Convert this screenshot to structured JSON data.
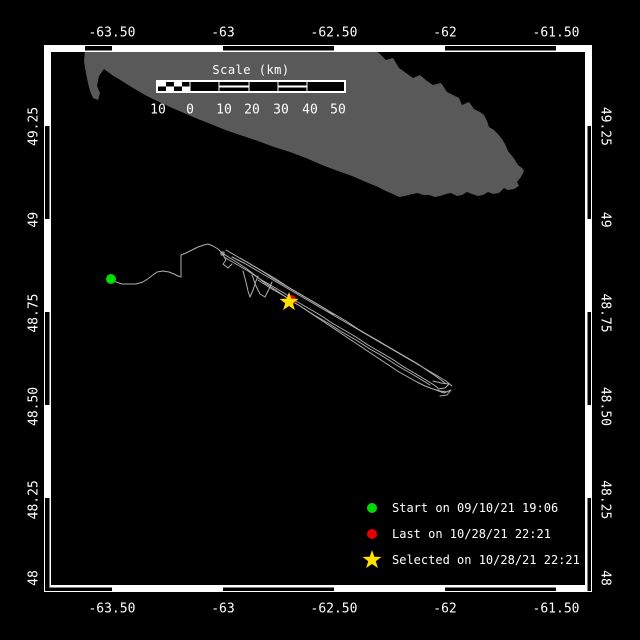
{
  "colors": {
    "background": "#000000",
    "frame": "#ffffff",
    "text": "#ffffff",
    "land": "#595959",
    "track": "#b0b0b0",
    "start": "#00dc00",
    "last": "#e80000",
    "selected": "#ffe000"
  },
  "scale_bar": {
    "title": "Scale (km)",
    "tick_labels": [
      "10",
      "0",
      "10",
      "20",
      "30",
      "40",
      "50"
    ],
    "geom": {
      "x": 157,
      "y": 81,
      "w": 188,
      "h": 11,
      "checker_start": 158,
      "checker_end": 190,
      "stripe_segs": [
        [
          219,
          249
        ],
        [
          278,
          307
        ]
      ],
      "separators": [
        190,
        219,
        249,
        278,
        307
      ],
      "label_xs": [
        158,
        190,
        224,
        252,
        281,
        310,
        338
      ],
      "labels_y": 110
    }
  },
  "legend": {
    "items": [
      {
        "marker": "start-dot",
        "label": "Start on 09/10/21 19:06"
      },
      {
        "marker": "last-dot",
        "label": "Last on 10/28/21 22:21"
      },
      {
        "marker": "selected-star",
        "label": "Selected on 10/28/21 22:21"
      }
    ]
  },
  "frame_pattern": {
    "top": [
      [
        85,
        112
      ],
      [
        223,
        334
      ],
      [
        445,
        556
      ]
    ],
    "bottom": [
      [
        44,
        112
      ],
      [
        223,
        334
      ],
      [
        445,
        556
      ]
    ],
    "left": [
      [
        126,
        219
      ],
      [
        312,
        405
      ],
      [
        498,
        591
      ]
    ],
    "right": [
      [
        126,
        219
      ],
      [
        312,
        405
      ],
      [
        498,
        591
      ]
    ]
  },
  "chart_data": {
    "type": "map-track",
    "description": "Telemetry track map with start, last and selected positions",
    "lon_axis": {
      "labels": [
        "-63.50",
        "-63",
        "-62.50",
        "-62",
        "-61.50"
      ],
      "values": [
        -63.5,
        -63,
        -62.5,
        -62,
        -61.5
      ]
    },
    "lat_axis": {
      "labels": [
        "49.25",
        "49",
        "48.75",
        "48.50",
        "48.25",
        "48"
      ],
      "values": [
        49.25,
        49,
        48.75,
        48.5,
        48.25,
        48
      ]
    },
    "projection": {
      "x0": 44,
      "x1": 592,
      "lon0": -63.806,
      "lon1": -61.338,
      "y0": 45,
      "y1": 592,
      "lat0": 49.468,
      "lat1": 48.003
    },
    "label_pos": {
      "top_y": 33,
      "bottom_y": 609,
      "left_x": 34,
      "right_x": 605,
      "lat_clamp_y": 578
    },
    "markers": {
      "start": {
        "lon": -63.5,
        "lat": 48.84,
        "px": [
          111,
          279
        ],
        "r": 5
      },
      "last": {
        "lon": -62.69,
        "lat": 48.78,
        "px": [
          291,
          300
        ],
        "r": 5
      },
      "selected": {
        "lon": -62.7,
        "lat": 48.78,
        "px": [
          289,
          302
        ],
        "R": 10,
        "r": 4
      }
    },
    "island_polygon": [
      [
        85,
        48
      ],
      [
        373,
        48
      ],
      [
        380,
        54
      ],
      [
        386,
        60
      ],
      [
        393,
        58
      ],
      [
        399,
        68
      ],
      [
        406,
        73
      ],
      [
        413,
        78
      ],
      [
        420,
        75
      ],
      [
        427,
        81
      ],
      [
        433,
        85
      ],
      [
        441,
        83
      ],
      [
        447,
        92
      ],
      [
        453,
        95
      ],
      [
        459,
        98
      ],
      [
        462,
        105
      ],
      [
        469,
        102
      ],
      [
        474,
        109
      ],
      [
        480,
        112
      ],
      [
        484,
        115
      ],
      [
        487,
        121
      ],
      [
        489,
        127
      ],
      [
        494,
        130
      ],
      [
        498,
        134
      ],
      [
        502,
        139
      ],
      [
        505,
        144
      ],
      [
        508,
        151
      ],
      [
        512,
        156
      ],
      [
        515,
        160
      ],
      [
        518,
        165
      ],
      [
        522,
        168
      ],
      [
        524,
        171
      ],
      [
        521,
        177
      ],
      [
        517,
        182
      ],
      [
        519,
        186
      ],
      [
        514,
        189
      ],
      [
        508,
        190
      ],
      [
        504,
        188
      ],
      [
        499,
        193
      ],
      [
        493,
        194
      ],
      [
        488,
        192
      ],
      [
        483,
        195
      ],
      [
        478,
        196
      ],
      [
        472,
        194
      ],
      [
        467,
        192
      ],
      [
        462,
        195
      ],
      [
        457,
        196
      ],
      [
        451,
        193
      ],
      [
        446,
        194
      ],
      [
        440,
        196
      ],
      [
        435,
        197
      ],
      [
        429,
        195
      ],
      [
        423,
        195
      ],
      [
        418,
        193
      ],
      [
        412,
        194
      ],
      [
        405,
        196
      ],
      [
        399,
        197
      ],
      [
        393,
        194
      ],
      [
        388,
        192
      ],
      [
        378,
        187
      ],
      [
        366,
        182
      ],
      [
        352,
        176
      ],
      [
        338,
        171
      ],
      [
        322,
        165
      ],
      [
        306,
        158
      ],
      [
        290,
        152
      ],
      [
        274,
        147
      ],
      [
        258,
        141
      ],
      [
        243,
        136
      ],
      [
        228,
        131
      ],
      [
        213,
        125
      ],
      [
        198,
        119
      ],
      [
        184,
        113
      ],
      [
        170,
        107
      ],
      [
        157,
        101
      ],
      [
        145,
        95
      ],
      [
        133,
        88
      ],
      [
        122,
        81
      ],
      [
        112,
        75
      ],
      [
        104,
        69
      ],
      [
        99,
        76
      ],
      [
        97,
        86
      ],
      [
        100,
        93
      ],
      [
        98,
        100
      ],
      [
        93,
        98
      ],
      [
        90,
        91
      ],
      [
        88,
        83
      ],
      [
        86,
        73
      ],
      [
        84,
        62
      ]
    ],
    "track_strands": [
      [
        [
          111,
          279
        ],
        [
          116,
          282
        ],
        [
          122,
          284
        ],
        [
          129,
          284
        ],
        [
          136,
          284
        ],
        [
          143,
          282
        ],
        [
          149,
          278
        ],
        [
          153,
          275
        ],
        [
          157,
          272
        ],
        [
          163,
          271
        ],
        [
          169,
          272
        ],
        [
          174,
          274
        ],
        [
          178,
          276
        ],
        [
          181,
          277
        ],
        [
          181,
          255
        ],
        [
          186,
          253
        ],
        [
          192,
          250
        ],
        [
          198,
          247
        ],
        [
          204,
          245
        ],
        [
          208,
          244
        ],
        [
          213,
          246
        ],
        [
          218,
          249
        ],
        [
          222,
          253
        ],
        [
          230,
          258
        ],
        [
          238,
          263
        ],
        [
          247,
          269
        ],
        [
          256,
          276
        ],
        [
          265,
          283
        ],
        [
          274,
          289
        ],
        [
          283,
          295
        ],
        [
          291,
          301
        ],
        [
          300,
          306
        ],
        [
          309,
          312
        ],
        [
          318,
          318
        ],
        [
          327,
          324
        ],
        [
          336,
          330
        ],
        [
          345,
          336
        ],
        [
          354,
          342
        ],
        [
          363,
          348
        ],
        [
          372,
          354
        ],
        [
          381,
          360
        ],
        [
          390,
          366
        ],
        [
          399,
          372
        ],
        [
          408,
          377
        ],
        [
          417,
          382
        ],
        [
          425,
          386
        ],
        [
          433,
          389
        ],
        [
          440,
          391
        ],
        [
          447,
          392
        ]
      ],
      [
        [
          226,
          250
        ],
        [
          238,
          257
        ],
        [
          250,
          264
        ],
        [
          262,
          271
        ],
        [
          274,
          279
        ],
        [
          286,
          286
        ],
        [
          298,
          293
        ],
        [
          310,
          300
        ],
        [
          322,
          307
        ],
        [
          334,
          314
        ],
        [
          346,
          321
        ],
        [
          358,
          329
        ],
        [
          370,
          336
        ],
        [
          382,
          343
        ],
        [
          394,
          350
        ],
        [
          406,
          357
        ],
        [
          418,
          364
        ],
        [
          428,
          371
        ],
        [
          437,
          377
        ],
        [
          445,
          383
        ]
      ],
      [
        [
          232,
          257
        ],
        [
          244,
          263
        ],
        [
          256,
          270
        ],
        [
          268,
          277
        ],
        [
          280,
          284
        ],
        [
          292,
          291
        ],
        [
          304,
          298
        ],
        [
          316,
          305
        ],
        [
          328,
          312
        ],
        [
          340,
          319
        ],
        [
          352,
          326
        ],
        [
          364,
          333
        ],
        [
          376,
          340
        ],
        [
          388,
          347
        ],
        [
          400,
          354
        ],
        [
          412,
          361
        ],
        [
          424,
          368
        ],
        [
          436,
          375
        ],
        [
          446,
          381
        ],
        [
          452,
          386
        ]
      ],
      [
        [
          224,
          257
        ],
        [
          236,
          264
        ],
        [
          248,
          271
        ],
        [
          260,
          279
        ],
        [
          272,
          286
        ],
        [
          284,
          293
        ],
        [
          296,
          301
        ],
        [
          308,
          308
        ],
        [
          320,
          315
        ],
        [
          332,
          323
        ],
        [
          344,
          330
        ],
        [
          356,
          337
        ],
        [
          368,
          345
        ],
        [
          380,
          352
        ],
        [
          392,
          359
        ],
        [
          404,
          367
        ],
        [
          416,
          374
        ],
        [
          426,
          380
        ],
        [
          434,
          385
        ],
        [
          438,
          388
        ]
      ],
      [
        [
          258,
          280
        ],
        [
          272,
          289
        ],
        [
          286,
          297
        ],
        [
          300,
          306
        ],
        [
          314,
          315
        ],
        [
          328,
          323
        ],
        [
          342,
          332
        ],
        [
          356,
          340
        ],
        [
          370,
          349
        ],
        [
          384,
          357
        ],
        [
          398,
          366
        ],
        [
          412,
          374
        ],
        [
          422,
          380
        ],
        [
          430,
          385
        ]
      ],
      [
        [
          240,
          258
        ],
        [
          252,
          265
        ],
        [
          264,
          272
        ],
        [
          276,
          279
        ],
        [
          288,
          287
        ],
        [
          300,
          294
        ],
        [
          312,
          301
        ],
        [
          324,
          308
        ],
        [
          334,
          315
        ]
      ],
      [
        [
          243,
          271
        ],
        [
          246,
          282
        ],
        [
          248,
          291
        ],
        [
          250,
          297
        ],
        [
          253,
          290
        ],
        [
          256,
          281
        ],
        [
          258,
          276
        ]
      ],
      [
        [
          252,
          275
        ],
        [
          256,
          286
        ],
        [
          260,
          294
        ],
        [
          265,
          297
        ],
        [
          269,
          289
        ],
        [
          272,
          282
        ]
      ],
      [
        [
          222,
          253
        ],
        [
          226,
          260
        ],
        [
          223,
          264
        ],
        [
          228,
          268
        ],
        [
          232,
          264
        ]
      ],
      [
        [
          221,
          252
        ],
        [
          224,
          252
        ],
        [
          224,
          255
        ],
        [
          221,
          255
        ],
        [
          221,
          252
        ]
      ],
      [
        [
          433,
          381
        ],
        [
          441,
          383
        ],
        [
          449,
          384
        ],
        [
          445,
          388
        ],
        [
          438,
          389
        ]
      ],
      [
        [
          436,
          390
        ],
        [
          444,
          393
        ],
        [
          451,
          390
        ],
        [
          447,
          395
        ],
        [
          440,
          396
        ]
      ]
    ]
  }
}
